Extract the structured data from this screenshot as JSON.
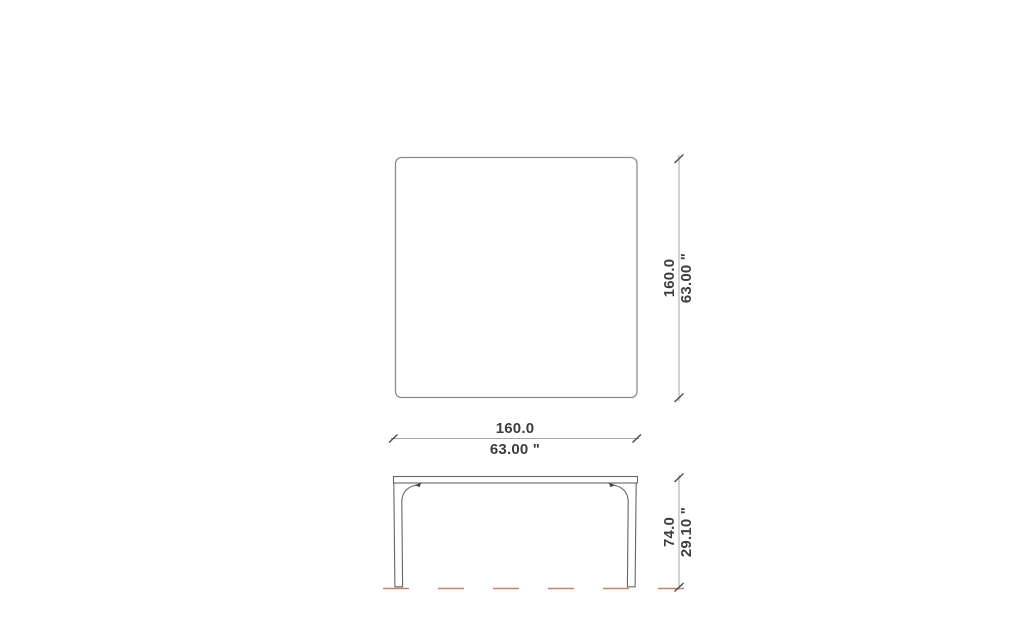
{
  "drawing": {
    "description": "furniture-technical-drawing-table",
    "background": "#ffffff",
    "top_view": {
      "depth_dimension": {
        "metric": "160.0",
        "imperial": "63.00 \""
      },
      "width_dimension": {
        "metric": "160.0",
        "imperial": "63.00 \""
      }
    },
    "front_view": {
      "height_dimension": {
        "metric": "74.0",
        "imperial": "29.10 \""
      }
    },
    "colors": {
      "top_view_outline": "#8c8c8c",
      "front_view_outline": "#666666",
      "dimension_line": "#a6a6a6",
      "dimension_tick": "#4a4a4a",
      "label_text": "#3e3e3e",
      "ground_line": "#c5846e"
    }
  }
}
